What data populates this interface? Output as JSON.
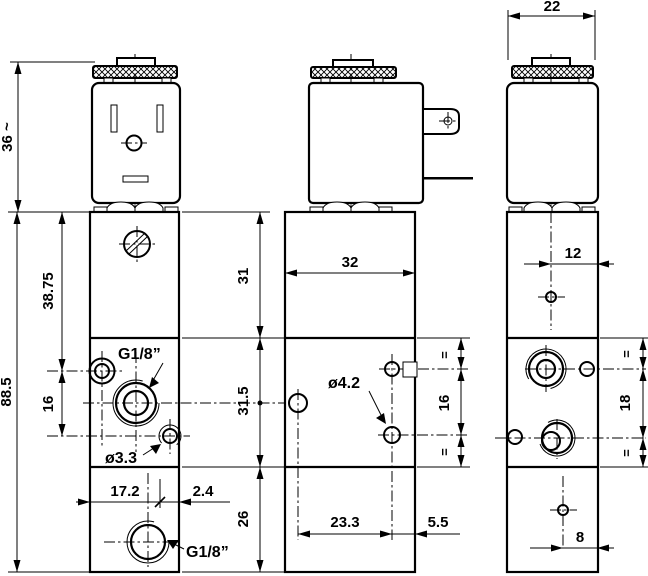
{
  "drawing": {
    "description": "Solenoid valve three-view dimension drawing",
    "colors": {
      "ink": "#000000",
      "paper": "#ffffff"
    },
    "front": {
      "coil_height": "36 ~",
      "total_height": "88.5",
      "upper_port_offset": "38.75",
      "port_spacing": "16",
      "side_port_thread": "G1/8”",
      "mount_hole_dia": "ø3.3",
      "bottom_port_offset": "17.2",
      "bottom_port_edge_offset": "2.4",
      "bottom_port_thread": "G1/8”"
    },
    "middle": {
      "upper_section_height": "31",
      "middle_section_height": "31.5",
      "lower_section_height": "26",
      "body_width": "32",
      "pilot_hole_dia": "ø4.2",
      "hole_spacing": "16",
      "equal_mark_top": "=",
      "equal_mark_bottom": "=",
      "hole_offset": "23.3",
      "hole_edge_offset": "5.5"
    },
    "right": {
      "body_depth": "22",
      "vent_offset_top": "12",
      "port_spacing": "18",
      "equal_mark_top": "=",
      "equal_mark_bottom": "=",
      "vent_offset_bottom": "8"
    }
  }
}
